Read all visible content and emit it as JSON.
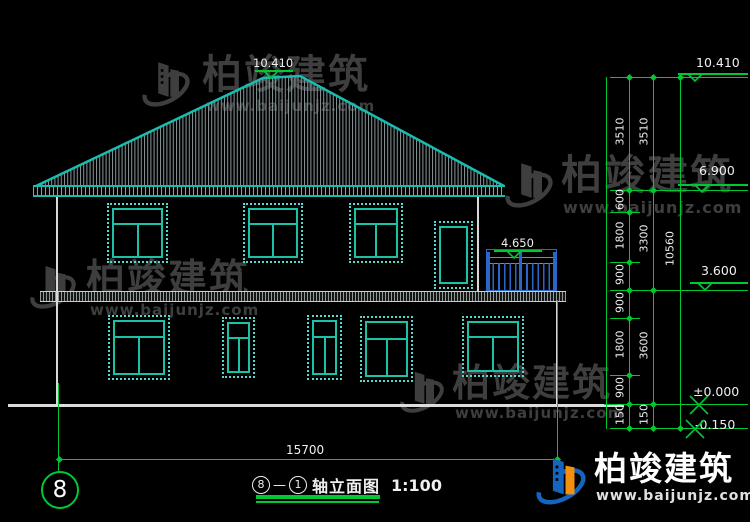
{
  "watermark": {
    "brand": "柏竣建筑",
    "url": "www.baijunjz.com"
  },
  "title": {
    "axis_from": "8",
    "dash": "—",
    "axis_to": "1",
    "name": "轴立面图",
    "scale": "1:100"
  },
  "axis": {
    "bubble": "8"
  },
  "dimensions": {
    "total_width": "15700",
    "col1": [
      "3510",
      "600",
      "1800",
      "900",
      "900",
      "1800",
      "900",
      "150"
    ],
    "col2": [
      "3510",
      "3300",
      "3600",
      "150"
    ],
    "col3": [
      "10560"
    ]
  },
  "elevations": {
    "roof_peak": "10.410",
    "eave": "6.900",
    "floor2": "3.600",
    "ground": "±0.000",
    "grade": "-0.150",
    "balcony": "4.650"
  },
  "colors": {
    "teal": "#18bdb0",
    "dim_green": "#00c832",
    "balcony_blue": "#2a66c8",
    "logo_blue": "#1565c0",
    "logo_orange": "#f5900e",
    "watermark_gray": "#3e3e3e"
  }
}
